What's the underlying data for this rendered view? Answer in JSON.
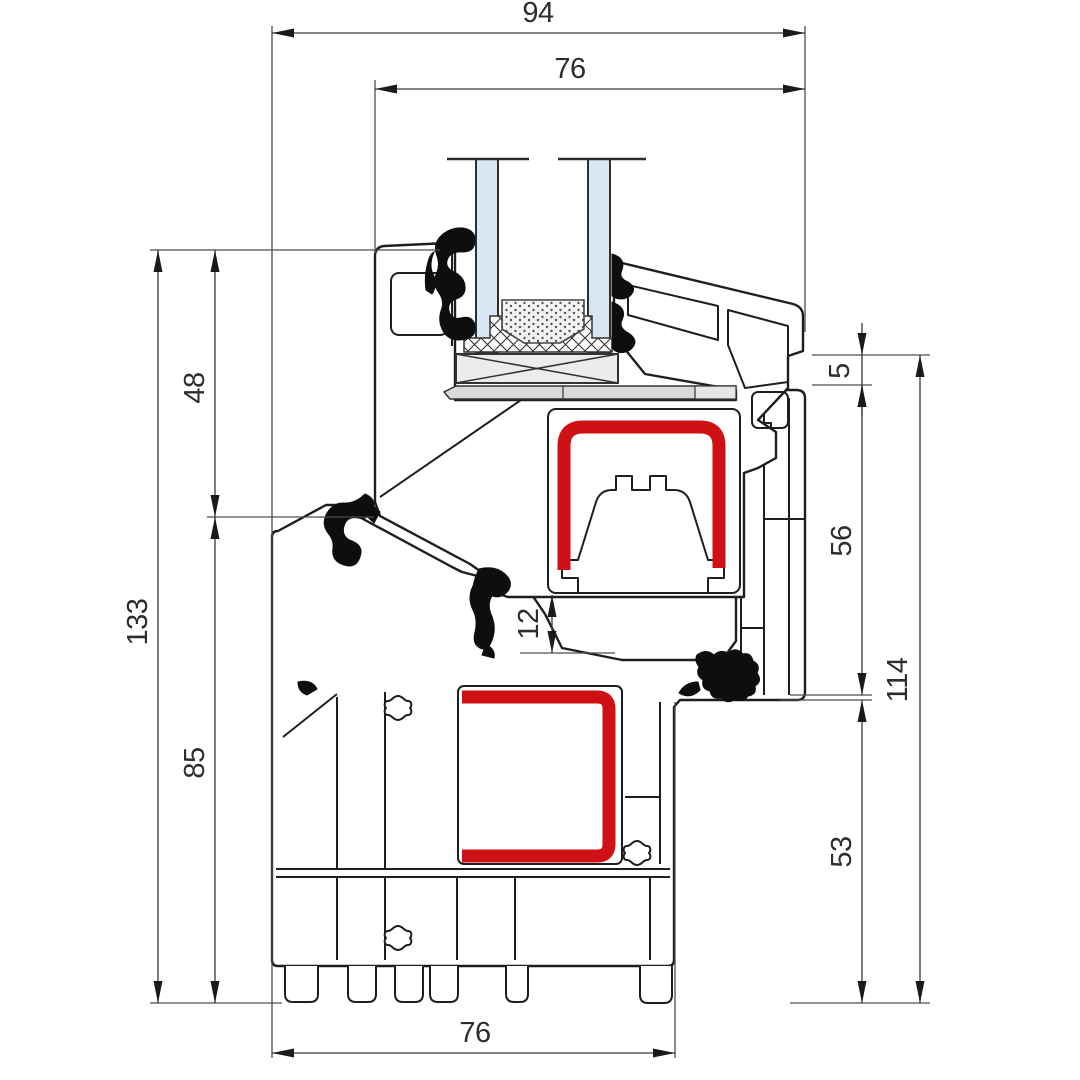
{
  "drawing": {
    "type": "technical-cross-section",
    "subject": "pvc-window-frame-and-sash-profile",
    "colors": {
      "line": "#1e1e1e",
      "steel_red": "#cf1014",
      "glass_blue": "#d9e7f5",
      "glazing_block_gray": "#ececec",
      "packer_gray": "#d9d9d9",
      "packer_gray_light": "#e6e6e6",
      "gasket_black": "#0e0e0e",
      "dim_text": "#2d2d2d"
    },
    "dimensions": [
      {
        "id": "width-total",
        "label": "94",
        "axis": "h",
        "pos": 33,
        "from": 272,
        "to": 805,
        "tx": 538,
        "ty": 22,
        "outside": false
      },
      {
        "id": "width-sash",
        "label": "76",
        "axis": "h",
        "pos": 89,
        "from": 375,
        "to": 805,
        "tx": 570,
        "ty": 78,
        "outside": false
      },
      {
        "id": "height-total-left",
        "label": "133",
        "axis": "v",
        "pos": 158,
        "from": 250,
        "to": 1003,
        "tx": 147,
        "ty": 622,
        "outside": false
      },
      {
        "id": "height-sash-left",
        "label": "48",
        "axis": "v",
        "pos": 215,
        "from": 250,
        "to": 517,
        "tx": 204,
        "ty": 388,
        "outside": false
      },
      {
        "id": "height-frame-left",
        "label": "85",
        "axis": "v",
        "pos": 215,
        "from": 517,
        "to": 1003,
        "tx": 204,
        "ty": 763,
        "outside": false
      },
      {
        "id": "gap-center",
        "label": "12",
        "axis": "v",
        "pos": 552,
        "from": 595,
        "to": 653,
        "tx": 538,
        "ty": 624,
        "outside": false
      },
      {
        "id": "overlap-step",
        "label": "5",
        "axis": "v",
        "pos": 862,
        "from": 355,
        "to": 385,
        "tx": 849,
        "ty": 371,
        "outside": true
      },
      {
        "id": "height-rebate-right",
        "label": "56",
        "axis": "v",
        "pos": 862,
        "from": 385,
        "to": 695,
        "tx": 851,
        "ty": 541,
        "outside": false
      },
      {
        "id": "height-base-right",
        "label": "53",
        "axis": "v",
        "pos": 862,
        "from": 700,
        "to": 1003,
        "tx": 851,
        "ty": 852,
        "outside": false
      },
      {
        "id": "height-frame-right",
        "label": "114",
        "axis": "v",
        "pos": 920,
        "from": 355,
        "to": 1003,
        "tx": 907,
        "ty": 680,
        "outside": false
      },
      {
        "id": "width-frame-bottom",
        "label": "76",
        "axis": "h",
        "pos": 1053,
        "from": 272,
        "to": 675,
        "tx": 475,
        "ty": 1042,
        "outside": false
      }
    ]
  }
}
